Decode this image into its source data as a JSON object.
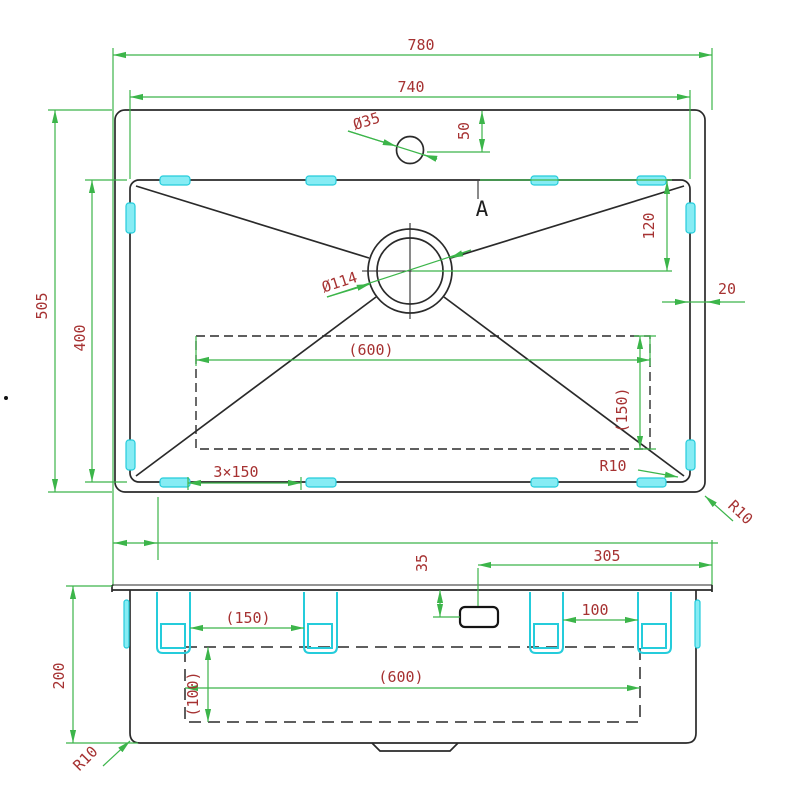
{
  "colors": {
    "dimension_line": "#3cb54a",
    "dimension_text": "#a63232",
    "outline": "#2a2a2a",
    "clip_stroke": "#25ccdb",
    "clip_fill": "#86ecf4",
    "background": "#ffffff"
  },
  "top_view": {
    "overall_width": "780",
    "bowl_width": "740",
    "overall_depth": "505",
    "bowl_depth": "400",
    "faucet_hole_dia": "Ø35",
    "faucet_offset": "50",
    "section_label": "A",
    "drain_dia": "Ø114",
    "drain_offset": "120",
    "rim_width": "20",
    "base_pad_width": "(600)",
    "base_pad_depth": "(150)",
    "clip_pitch": "3×150",
    "bowl_corner_radius": "R10",
    "outer_corner_radius": "R10"
  },
  "front_view": {
    "height": "200",
    "outlet_offset_top": "35",
    "outlet_offset_right": "305",
    "clip_span_right": "100",
    "clip_span_left": "(150)",
    "base_pad_width": "(600)",
    "base_pad_height": "(100)",
    "corner_radius": "R10"
  }
}
